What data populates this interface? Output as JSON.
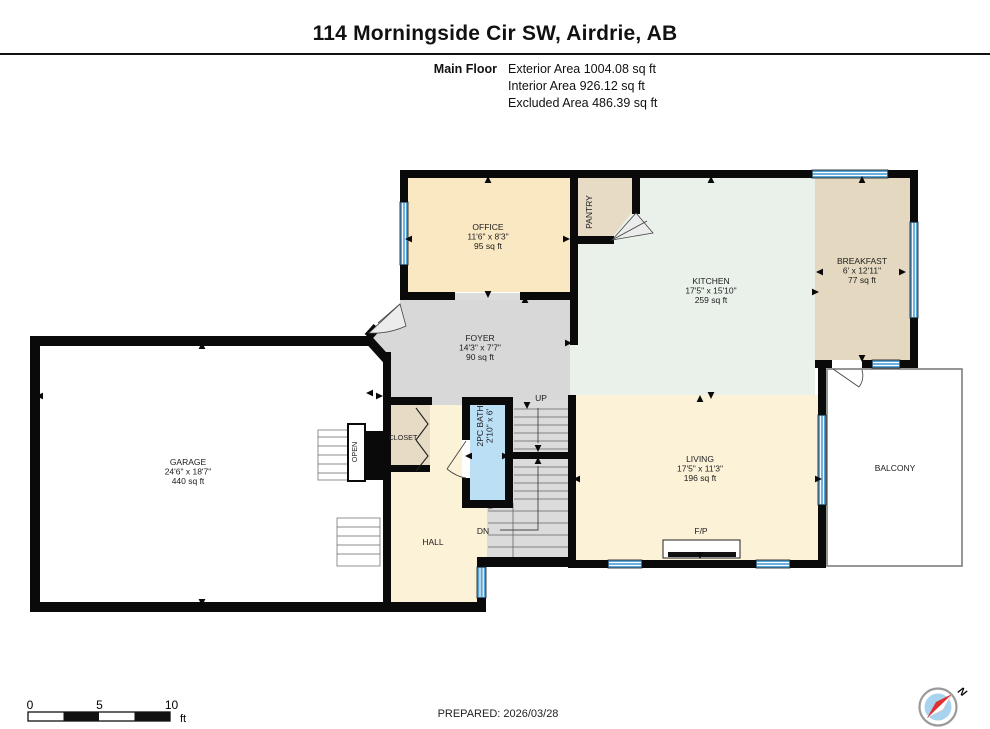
{
  "header": {
    "title": "114 Morningside Cir SW, Airdrie, AB",
    "floor_label": "Main Floor",
    "stats": {
      "exterior": "Exterior Area 1004.08 sq ft",
      "interior": "Interior Area 926.12 sq ft",
      "excluded": "Excluded Area 486.39 sq ft"
    }
  },
  "rooms": {
    "office": {
      "name": "OFFICE",
      "dims": "11'6\" x 8'3\"",
      "area": "95 sq ft"
    },
    "pantry": {
      "name": "PANTRY"
    },
    "kitchen": {
      "name": "KITCHEN",
      "dims": "17'5\" x 15'10\"",
      "area": "259 sq ft"
    },
    "breakfast": {
      "name": "BREAKFAST",
      "dims": "6' x 12'11\"",
      "area": "77 sq ft"
    },
    "foyer": {
      "name": "FOYER",
      "dims": "14'3\" x 7'7\"",
      "area": "90 sq ft"
    },
    "garage": {
      "name": "GARAGE",
      "dims": "24'6\" x 18'7\"",
      "area": "440 sq ft"
    },
    "living": {
      "name": "LIVING",
      "dims": "17'5\" x 11'3\"",
      "area": "196 sq ft"
    },
    "bath": {
      "name": "2PC BATH",
      "dims": "2'10\" x 6'"
    },
    "closet": {
      "name": "CLOSET"
    },
    "hall": {
      "name": "HALL"
    },
    "balcony": {
      "name": "BALCONY"
    },
    "open_label": "OPEN",
    "fireplace": "F/P",
    "up": "UP",
    "dn": "DN"
  },
  "footer": {
    "prepared": "PREPARED: 2026/03/28",
    "scale": {
      "t0": "0",
      "t5": "5",
      "t10": "10",
      "unit": "ft"
    },
    "north": "N"
  },
  "colors": {
    "wall": "#0a0a0a",
    "window": "#58A5D8",
    "office": "#FAE8C3",
    "pantry": "#E7DBC6",
    "kitchen": "#E9F1EA",
    "breakfast": "#E4D8C0",
    "foyer": "#D8D8D8",
    "living": "#FBF2D8",
    "hall": "#FBF2D8",
    "closet": "#E7DBC6",
    "bath": "#BBDFF5",
    "stairs": "#DBDBDB",
    "compass_face": "#A8D3EE",
    "needle_red": "#E03030"
  }
}
